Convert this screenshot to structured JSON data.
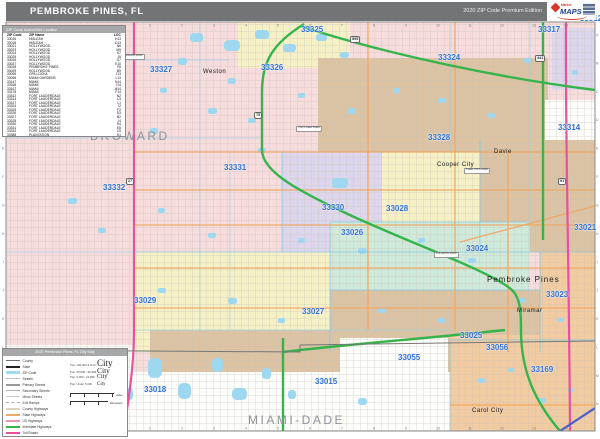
{
  "header": {
    "title": "PEMBROKE PINES, FL",
    "edition": "2020 ZIP Code Premium Edition",
    "logo": {
      "market": "Market",
      "brand": "MAPS"
    }
  },
  "zip_table": {
    "title": "ZIP Code Index/Grid Locator",
    "columns": [
      "ZIP Code",
      "ZIP Name",
      "LOC"
    ],
    "rows": [
      [
        "33016",
        "HIALEAH",
        "H13"
      ],
      [
        "33018",
        "HIALEAH",
        "D13"
      ],
      [
        "33021",
        "HOLLYWOOD",
        "N6"
      ],
      [
        "33023",
        "HOLLYWOOD",
        "M9"
      ],
      [
        "33024",
        "HOLLYWOOD",
        "K7"
      ],
      [
        "33025",
        "HOLLYWOOD",
        "J9"
      ],
      [
        "33026",
        "HOLLYWOOD",
        "G7"
      ],
      [
        "33027",
        "HOLLYWOOD",
        "E10"
      ],
      [
        "33028",
        "PEMBROKE PINES",
        "F8"
      ],
      [
        "33029",
        "HOLLYWOOD",
        "B9"
      ],
      [
        "33055",
        "OPA LOCKA",
        "J13"
      ],
      [
        "33056",
        "MIAMI GARDENS",
        "L13"
      ],
      [
        "33147",
        "MIAMI",
        "N14"
      ],
      [
        "33166",
        "MIAMI",
        "J14"
      ],
      [
        "33167",
        "MIAMI",
        "M14"
      ],
      [
        "33178",
        "MIAMI",
        "F14"
      ],
      [
        "33312",
        "FORT LAUDERDALE",
        "N2"
      ],
      [
        "33314",
        "FORT LAUDERDALE",
        "L3"
      ],
      [
        "33317",
        "FORT LAUDERDALE",
        "L1"
      ],
      [
        "33324",
        "FORT LAUDERDALE",
        "I2"
      ],
      [
        "33325",
        "FORT LAUDERDALE",
        "F2"
      ],
      [
        "33326",
        "FORT LAUDERDALE",
        "D3"
      ],
      [
        "33327",
        "FORT LAUDERDALE",
        "B2"
      ],
      [
        "33328",
        "FORT LAUDERDALE",
        "J4"
      ],
      [
        "33330",
        "FORT LAUDERDALE",
        "H4"
      ],
      [
        "33331",
        "FORT LAUDERDALE",
        "E5"
      ],
      [
        "33332",
        "FORT LAUDERDALE",
        "C5"
      ],
      [
        "33388",
        "PLANTATION",
        "K1"
      ]
    ]
  },
  "legend": {
    "title": "2020 Pembroke Pines, FL City Map",
    "line_items": [
      {
        "label": "County",
        "color": "#6e6e6e",
        "h": 1.6,
        "dash": false
      },
      {
        "label": "State",
        "color": "#222222",
        "h": 2.0,
        "dash": false
      },
      {
        "label": "ZIP Code",
        "color": "#9fd9f0",
        "h": 3.0,
        "dash": false
      },
      {
        "label": "Streets",
        "color": "#c9c2b8",
        "h": 1.0,
        "dash": false
      },
      {
        "label": "Primary Streets",
        "color": "#9a9a9a",
        "h": 1.6,
        "dash": false
      },
      {
        "label": "Secondary Streets",
        "color": "#b5b0a8",
        "h": 1.2,
        "dash": false
      },
      {
        "label": "Minor Streets",
        "color": "#d2ccc2",
        "h": 1.0,
        "dash": false
      },
      {
        "label": "Exit Ramps",
        "color": "#b5b0a8",
        "h": 1.0,
        "dash": true
      },
      {
        "label": "County Highways",
        "color": "#d8d2c8",
        "h": 2.0,
        "dash": false
      },
      {
        "label": "State Highways",
        "color": "#f0a862",
        "h": 2.0,
        "dash": false
      },
      {
        "label": "US Highways",
        "color": "#e897b8",
        "h": 2.0,
        "dash": false
      },
      {
        "label": "Interstate Highways",
        "color": "#35b44c",
        "h": 2.6,
        "dash": false
      },
      {
        "label": "Toll Roads",
        "color": "#e9519e",
        "h": 2.2,
        "dash": false
      }
    ],
    "city_sizes": [
      {
        "label": "Pop. 100,000 & Over",
        "sample": "City",
        "size": 9
      },
      {
        "label": "Pop. 25,000 - 99,999",
        "sample": "City",
        "size": 7.5
      },
      {
        "label": "Pop. 5,000 - 24,999",
        "sample": "City",
        "size": 6
      },
      {
        "label": "Pop. Under 5,000",
        "sample": "City",
        "size": 5
      }
    ],
    "scale": {
      "miles_label": "miles",
      "km_label": "kilometers"
    }
  },
  "map": {
    "counties": [
      {
        "name": "BROWARD",
        "x": 90,
        "y": 129
      },
      {
        "name": "MIAMI-DADE",
        "x": 248,
        "y": 413
      }
    ],
    "cities": [
      {
        "name": "Plantation",
        "x": 426,
        "y": 14,
        "s": 6
      },
      {
        "name": "Weston",
        "x": 203,
        "y": 69,
        "s": 6
      },
      {
        "name": "Davie",
        "x": 494,
        "y": 149,
        "s": 6
      },
      {
        "name": "Cooper City",
        "x": 437,
        "y": 162,
        "s": 6
      },
      {
        "name": "Pembroke Pines",
        "x": 487,
        "y": 275,
        "s": 8
      },
      {
        "name": "Miramar",
        "x": 517,
        "y": 308,
        "s": 6
      },
      {
        "name": "Carol City",
        "x": 472,
        "y": 408,
        "s": 6
      }
    ],
    "zip_labels": [
      {
        "code": "33327",
        "x": 150,
        "y": 65
      },
      {
        "code": "33326",
        "x": 261,
        "y": 63
      },
      {
        "code": "33325",
        "x": 301,
        "y": 25
      },
      {
        "code": "33324",
        "x": 438,
        "y": 53
      },
      {
        "code": "33317",
        "x": 538,
        "y": 25
      },
      {
        "code": "33312",
        "x": 580,
        "y": 14
      },
      {
        "code": "33314",
        "x": 558,
        "y": 123
      },
      {
        "code": "33328",
        "x": 428,
        "y": 133
      },
      {
        "code": "33331",
        "x": 224,
        "y": 163
      },
      {
        "code": "33332",
        "x": 103,
        "y": 183
      },
      {
        "code": "33330",
        "x": 322,
        "y": 203
      },
      {
        "code": "33028",
        "x": 386,
        "y": 204
      },
      {
        "code": "33026",
        "x": 341,
        "y": 228
      },
      {
        "code": "33024",
        "x": 466,
        "y": 244
      },
      {
        "code": "33029",
        "x": 134,
        "y": 296
      },
      {
        "code": "33027",
        "x": 302,
        "y": 307
      },
      {
        "code": "33023",
        "x": 546,
        "y": 290
      },
      {
        "code": "33021",
        "x": 574,
        "y": 223
      },
      {
        "code": "33025",
        "x": 460,
        "y": 331
      },
      {
        "code": "33056",
        "x": 486,
        "y": 343
      },
      {
        "code": "33055",
        "x": 398,
        "y": 353
      },
      {
        "code": "33169",
        "x": 531,
        "y": 365
      },
      {
        "code": "33018",
        "x": 144,
        "y": 385
      },
      {
        "code": "33015",
        "x": 315,
        "y": 377
      }
    ],
    "parks": [
      {
        "name": "MARKHAM PARK",
        "x": 120,
        "y": 54
      },
      {
        "name": "VISTA VIEW PARK",
        "x": 296,
        "y": 126
      },
      {
        "name": "TREE TOPS PARK",
        "x": 464,
        "y": 168
      },
      {
        "name": "C B SMITH PARK",
        "x": 434,
        "y": 252
      }
    ],
    "shields": [
      {
        "num": "75",
        "x": 254,
        "y": 112
      },
      {
        "num": "595",
        "x": 350,
        "y": 36
      },
      {
        "num": "27",
        "x": 126,
        "y": 178
      },
      {
        "num": "441",
        "x": 535,
        "y": 55
      },
      {
        "num": "91",
        "x": 558,
        "y": 178
      }
    ],
    "lakes": [
      [
        190,
        33,
        13,
        9
      ],
      [
        224,
        40,
        16,
        11
      ],
      [
        255,
        30,
        14,
        9
      ],
      [
        283,
        44,
        13,
        8
      ],
      [
        316,
        34,
        11,
        7
      ],
      [
        340,
        52,
        9,
        6
      ],
      [
        178,
        58,
        9,
        7
      ],
      [
        150,
        128,
        8,
        6
      ],
      [
        228,
        78,
        8,
        6
      ],
      [
        258,
        148,
        8,
        5
      ],
      [
        160,
        88,
        7,
        5
      ],
      [
        208,
        108,
        9,
        6
      ],
      [
        248,
        118,
        8,
        5
      ],
      [
        298,
        93,
        7,
        5
      ],
      [
        348,
        108,
        8,
        6
      ],
      [
        393,
        88,
        7,
        5
      ],
      [
        438,
        98,
        8,
        5
      ],
      [
        488,
        113,
        7,
        5
      ],
      [
        524,
        58,
        7,
        5
      ],
      [
        572,
        70,
        6,
        5
      ],
      [
        68,
        198,
        9,
        6
      ],
      [
        98,
        228,
        8,
        5
      ],
      [
        158,
        208,
        7,
        5
      ],
      [
        208,
        233,
        8,
        5
      ],
      [
        298,
        238,
        7,
        5
      ],
      [
        358,
        248,
        9,
        6
      ],
      [
        418,
        238,
        7,
        5
      ],
      [
        468,
        258,
        8,
        5
      ],
      [
        332,
        178,
        16,
        10
      ],
      [
        158,
        288,
        8,
        5
      ],
      [
        228,
        298,
        9,
        6
      ],
      [
        278,
        318,
        7,
        5
      ],
      [
        378,
        308,
        8,
        5
      ],
      [
        438,
        318,
        7,
        5
      ],
      [
        518,
        298,
        7,
        5
      ],
      [
        558,
        318,
        6,
        4
      ],
      [
        148,
        358,
        14,
        20
      ],
      [
        178,
        383,
        13,
        16
      ],
      [
        212,
        358,
        11,
        14
      ],
      [
        232,
        388,
        15,
        12
      ],
      [
        124,
        388,
        9,
        12
      ],
      [
        262,
        368,
        9,
        11
      ],
      [
        288,
        390,
        8,
        9
      ],
      [
        358,
        398,
        9,
        7
      ],
      [
        478,
        378,
        7,
        5
      ],
      [
        538,
        398,
        8,
        5
      ],
      [
        568,
        388,
        6,
        4
      ],
      [
        508,
        368,
        6,
        4
      ]
    ],
    "grid": {
      "cols": [
        "1",
        "2",
        "3",
        "4",
        "5",
        "6",
        "7",
        "8",
        "9",
        "10",
        "11",
        "12",
        "13",
        "14"
      ],
      "rows": [
        "A",
        "B",
        "C",
        "D",
        "E",
        "F",
        "G",
        "H",
        "I",
        "J",
        "K",
        "L",
        "M",
        "N"
      ]
    },
    "colors": {
      "header_bar": "#737476",
      "panel_header": "#a6a7a9",
      "pink": "#f6dcdc",
      "tan": "#dbc3a3",
      "yellow": "#f5f0c6",
      "teal": "#cfe9da",
      "lavender": "#ddd6ec",
      "orange": "#f1cba1",
      "white_area": "#fdfdfb",
      "water": "#9ed8f0",
      "street": "#d8d2c9",
      "canal": "#8fd2e8",
      "zip_line": "#7cc8e2",
      "road_interstate": "#35b44c",
      "road_toll": "#e9519e",
      "road_state": "#f0a862",
      "road_blue": "#4a5fd0",
      "zip_label": "#2e6fd6",
      "county_label": "#90939a",
      "map_border": "#8b8b8b"
    }
  }
}
